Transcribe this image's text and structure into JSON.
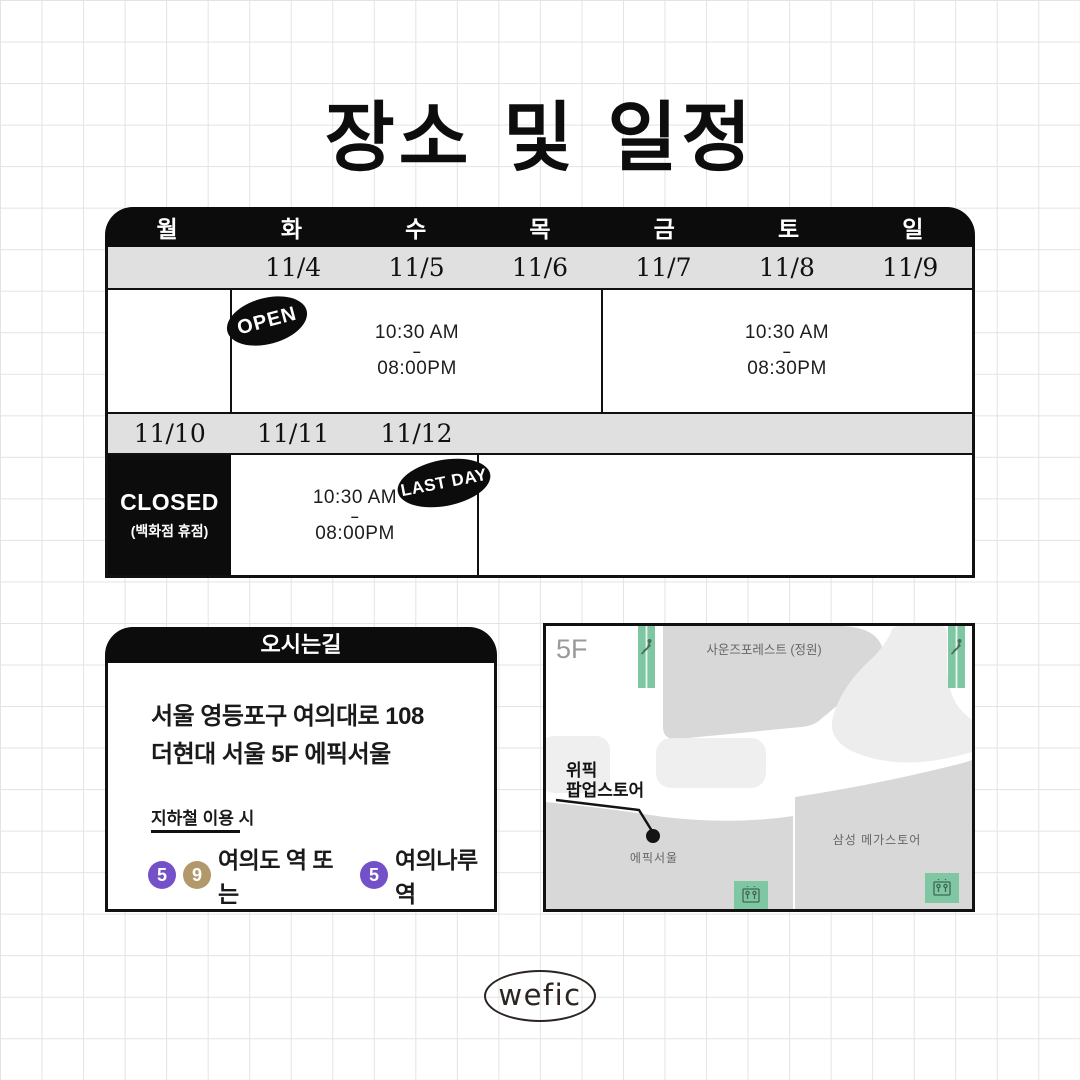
{
  "title": "장소 및 일정",
  "colors": {
    "black": "#0c0c0c",
    "table_row_gray": "#e0e0e0",
    "line5_purple": "#7450c9",
    "line9_gold": "#b2996b",
    "map_green": "#7fc7a3",
    "map_region_gray": "#d8d8d8",
    "map_island_gray": "#efefef"
  },
  "schedule": {
    "days": [
      "월",
      "화",
      "수",
      "목",
      "금",
      "토",
      "일"
    ],
    "week1_dates": [
      "11/4",
      "11/5",
      "11/6",
      "11/7",
      "11/8",
      "11/9"
    ],
    "week2_dates": [
      "11/10",
      "11/11",
      "11/12"
    ],
    "open_badge": "OPEN",
    "lastday_badge": "LAST DAY",
    "hours_tue_thu": {
      "start": "10:30 AM",
      "sep": "–",
      "end": "08:00PM"
    },
    "hours_fri_sun": {
      "start": "10:30 AM",
      "sep": "–",
      "end": "08:30PM"
    },
    "hours_week2": {
      "start": "10:30 AM",
      "sep": "–",
      "end": "08:00PM"
    },
    "closed": {
      "title": "CLOSED",
      "subtitle": "(백화점 휴점)"
    }
  },
  "directions": {
    "title": "오시는길",
    "address_line1": "서울 영등포구 여의대로 108",
    "address_line2": "더현대 서울 5F 에픽서울",
    "subway_note": "지하철 이용 시",
    "line5": "5",
    "line9": "9",
    "station_text1": "여의도 역 또는",
    "station_text2": "여의나루 역"
  },
  "map": {
    "floor": "5F",
    "garden_label": "사운즈포레스트 (정원)",
    "popup_line1": "위픽",
    "popup_line2": "팝업스토어",
    "epik_label": "에픽서울",
    "samsung_label": "삼성 메가스토어"
  },
  "footer": {
    "logo": "wefic"
  }
}
